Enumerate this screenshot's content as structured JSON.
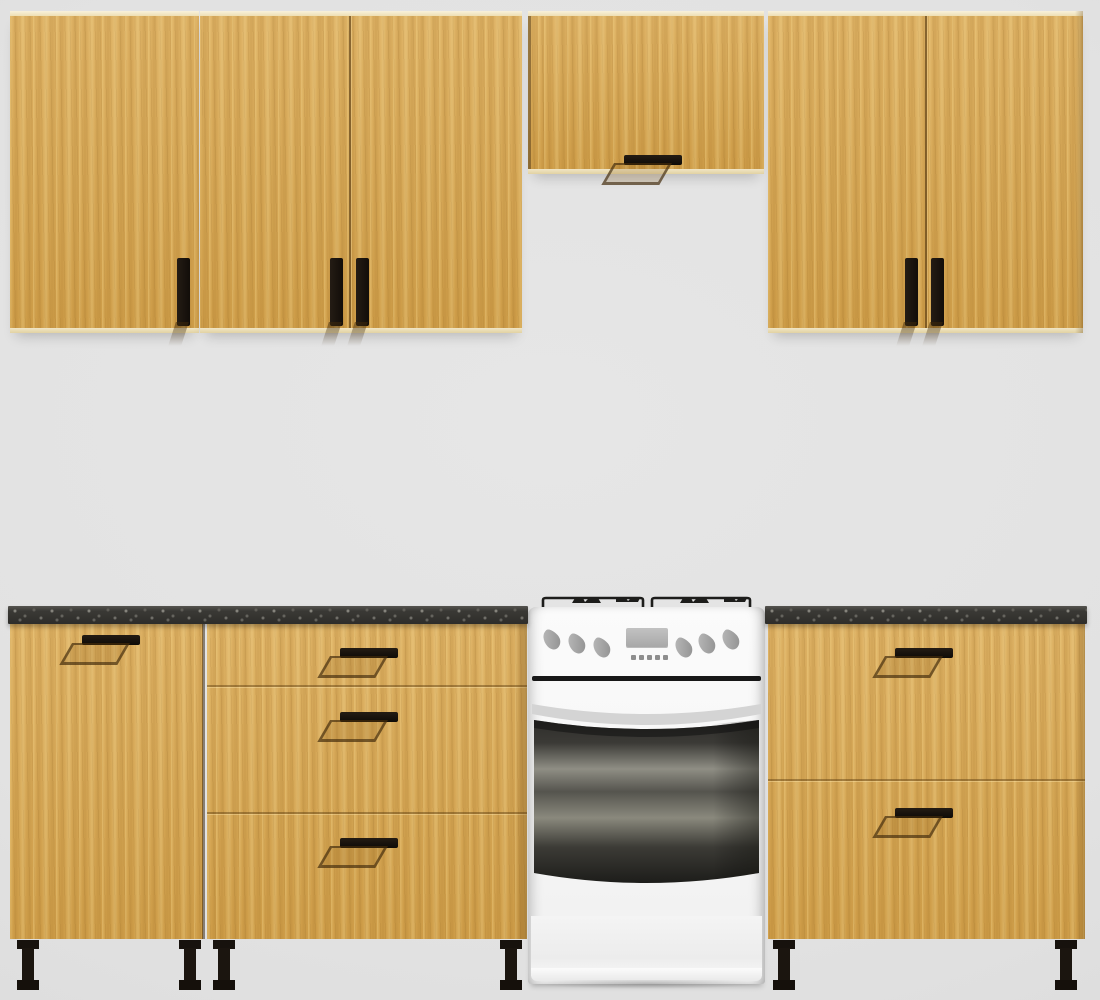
{
  "scene": {
    "title": "Modular kitchen set 3D render",
    "background_color": "#e2e2e2",
    "materials": {
      "cabinet_wood": "#d9a74f",
      "cabinet_wood_highlight": "#eecb7d",
      "cabinet_wood_shadow": "#b9883a",
      "cabinet_edge_light": "#f2e8cc",
      "countertop_dark": "#32312e",
      "countertop_fleck": "#6b6962",
      "handle_black": "#17120e",
      "leg_black": "#15110d",
      "stove_white": "#f7f7f7",
      "oven_glass_dark": "#26251f",
      "oven_glass_sheen": "#908e83"
    },
    "wall_row": {
      "left_single": {
        "label": "Wall cabinet, single door, vertical black handle",
        "doors": 1
      },
      "left_double": {
        "label": "Wall cabinet, double door, paired vertical handles",
        "doors": 2
      },
      "over_cooker": {
        "label": "Short wall cabinet above cooker, horizontal handle",
        "doors": 1
      },
      "right_double": {
        "label": "Wall cabinet, double door, paired vertical handles",
        "doors": 2
      }
    },
    "base_row": {
      "countertop_label": "Dark speckled stone countertop",
      "door_unit": {
        "label": "Base cabinet, single door, handle top left",
        "doors": 1
      },
      "drawer_unit_3": {
        "label": "Base cabinet with 3 drawers",
        "drawers": 3
      },
      "drawer_unit_2": {
        "label": "Base cabinet with 2 deep drawers",
        "drawers": 2
      }
    },
    "appliance": {
      "label": "White freestanding cooker with gas hob, oven window and storage drawer",
      "burner_grates": 2,
      "control_knobs": 6,
      "has_display": true,
      "display_buttons": 5
    },
    "legs": {
      "label": "Black plinth leg",
      "count": 6
    }
  }
}
